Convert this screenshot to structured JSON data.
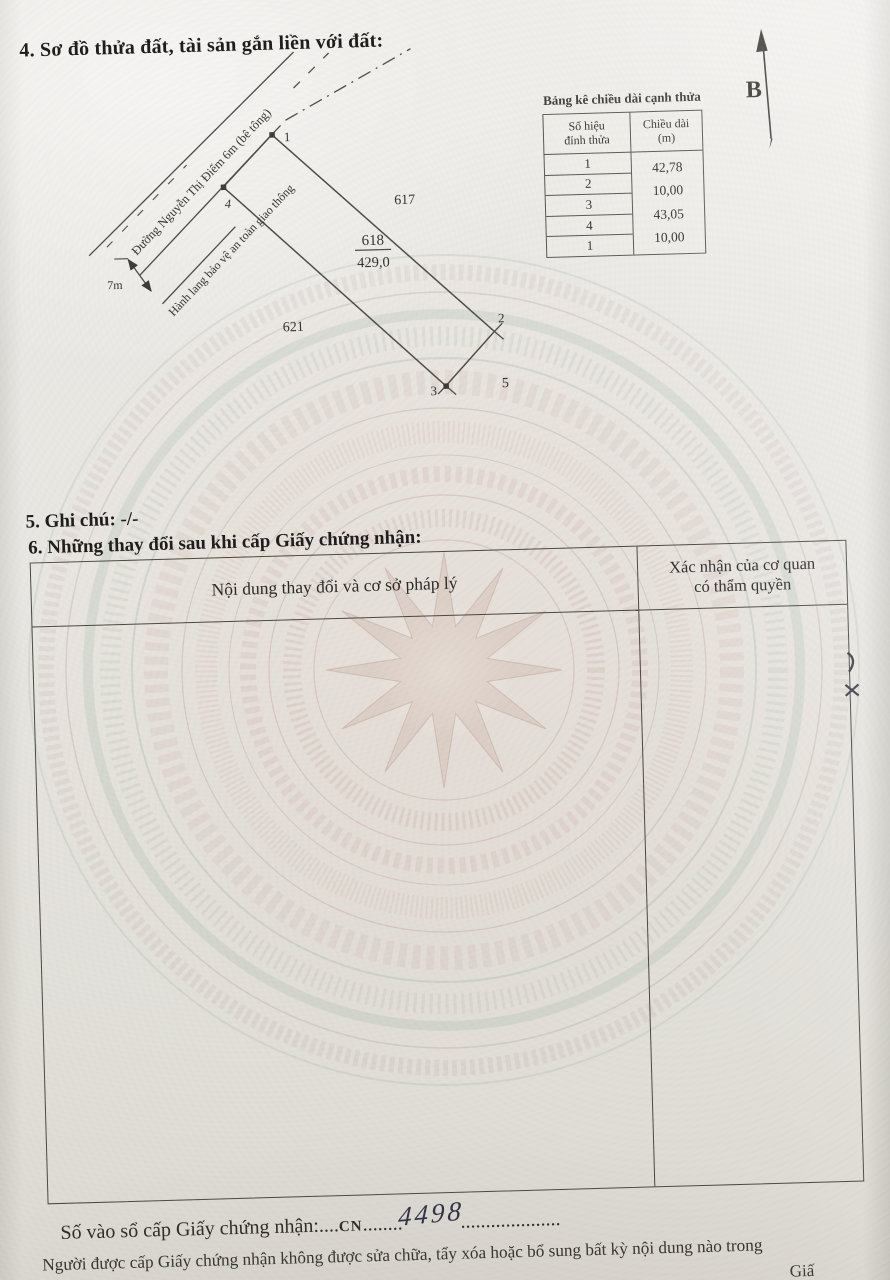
{
  "document": {
    "section4_title": "4. Sơ đồ thửa đất, tài sản gắn liền với đất:",
    "section5_line": "5. Ghi chú: -/-",
    "section6_title": "6. Những thay đổi sau khi cấp Giấy chứng nhận:"
  },
  "diagram": {
    "north_label": "B",
    "road_label": "Đường Nguyễn Thị Điểm 6m (bê tông)",
    "corridor_label": "Hành lang bảo vệ an toàn giao thông",
    "dim_label": "7m",
    "parcel": {
      "number": "618",
      "area": "429,0"
    },
    "neighbors": {
      "right": "617",
      "left": "621",
      "bottom": "5"
    },
    "vertex_labels": [
      "1",
      "2",
      "3",
      "4"
    ]
  },
  "edge_table": {
    "title": "Bảng kê chiều dài cạnh thửa",
    "col1_header": "Số hiệu\nđỉnh thửa",
    "col2_header": "Chiều dài\n(m)",
    "vertex_ids": [
      "1",
      "2",
      "3",
      "4",
      "1"
    ],
    "lengths": [
      "42,78",
      "10,00",
      "43,05",
      "10,00"
    ]
  },
  "changes_table": {
    "col1_header": "Nội dung thay đổi và cơ sở pháp lý",
    "col2_header": "Xác nhận của cơ quan\ncó thẩm quyền"
  },
  "footer": {
    "register_label": "Số vào sổ cấp Giấy chứng nhận:",
    "dots_a": "....",
    "code": "CN",
    "dots_b": "........",
    "number": "4498",
    "dots_c": "....................",
    "note_line": "Người được cấp Giấy chứng nhận không được sửa chữa, tẩy xóa hoặc bổ sung bất kỳ nội dung nào trong",
    "clipped_fragment": "Giấ"
  },
  "colors": {
    "paper": "#e9e7e2",
    "ink": "#2e2d2a",
    "watermark_pink": "#c8a79c",
    "watermark_teal": "#a8c4b4",
    "handwriting_ink": "#2d3144"
  }
}
